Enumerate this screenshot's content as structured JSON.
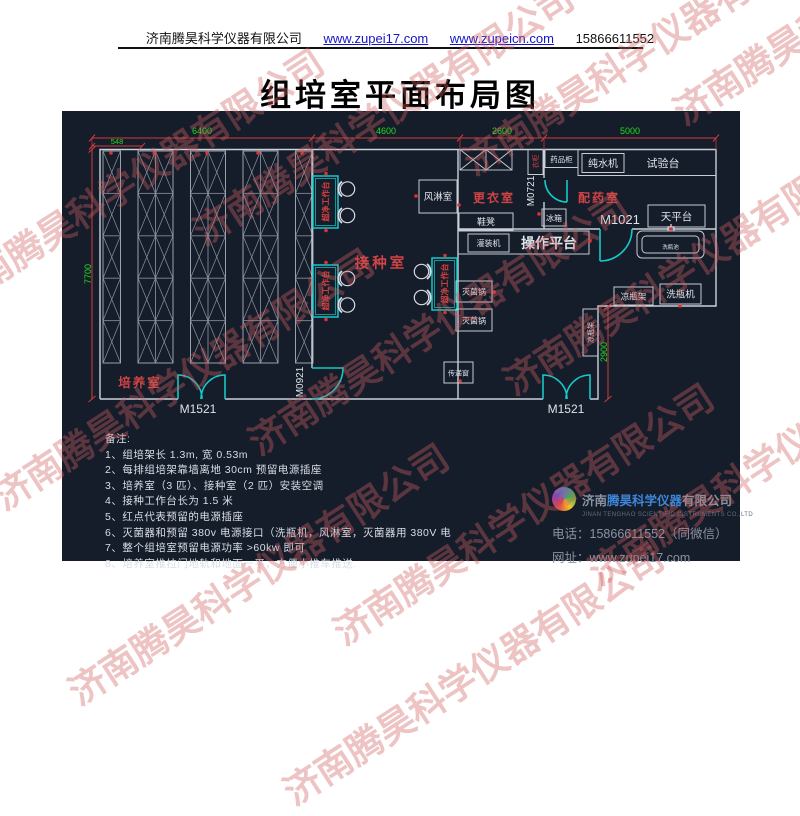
{
  "header": {
    "company": "济南腾昊科学仪器有限公司",
    "url1": "www.zupei17.com",
    "url2": "www.zupeicn.com",
    "phone": "15866611552"
  },
  "title": "组培室平面布局图",
  "watermark": {
    "text": "济南腾昊科学仪器有限公司"
  },
  "plan": {
    "dims": {
      "w_offset": "548",
      "w_culture": "6400",
      "w_inoculation": "4600",
      "w_changing": "2600",
      "w_dispensing": "5000",
      "h_total": "7700",
      "h_notch": "2900"
    },
    "rooms": {
      "culture": "培养室",
      "inoculation": "接种室",
      "changing": "更衣室",
      "dispensing": "配药室"
    },
    "doors": {
      "m1521": "M1521",
      "m0921": "M0921",
      "m0721": "M0721",
      "m1021": "M1021"
    },
    "equipment": {
      "clean_bench": "超净工作台",
      "air_shower": "风淋室",
      "locker": "衣柜",
      "medicine_cabinet": "药品柜",
      "pure_water_machine": "纯水机",
      "test_bench": "试验台",
      "balance_platform": "天平台",
      "fridge": "冰箱",
      "shoe_bench": "鞋凳",
      "filling_machine": "灌装机",
      "operation_platform": "操作平台",
      "sterilizer": "灭菌锅",
      "pass_window": "传递窗",
      "bottle_cool_rack": "凉瓶架",
      "bottle_washer": "洗瓶机",
      "wash_sink": "洗瓶池"
    }
  },
  "notes": {
    "title": "备注:",
    "items": [
      "1、组培架长 1.3m, 宽 0.53m",
      "2、每排组培架靠墙离地 30cm 预留电源插座",
      "3、培养室（3 匹）、接种室（2 匹）安装空调",
      "4、接种工作台长为 1.5 米",
      "5、红点代表预留的电源插座",
      "6、灭菌器和预留 380v 电源接口（洗瓶机，风淋室，灭菌器用 380V 电",
      "7、整个组培室预留电源功率 >60kw 即可",
      "8、培养室推拉门地轨和地面一平，方便小推车推送."
    ]
  },
  "footer": {
    "company_cn_grey1": "济南",
    "company_cn_blue": "腾昊科学仪器",
    "company_cn_grey2": "有限公司",
    "company_en": "JINAN TENGHAO SCIENTIFIC INSTRUMENTS CO.,LTD",
    "phone_label": "电话：",
    "phone": "15866611552（同微信）",
    "web_label": "网址：",
    "web": "www.zupei17.com"
  },
  "colors": {
    "bg_dark": "#151c2a",
    "wall_white": "#ccd2d9",
    "dim_red": "#d23c3c",
    "dim_green": "#22dd22",
    "door_cyan": "#14c9c9",
    "label_red": "#cf4444",
    "link_blue": "#1515c8"
  }
}
